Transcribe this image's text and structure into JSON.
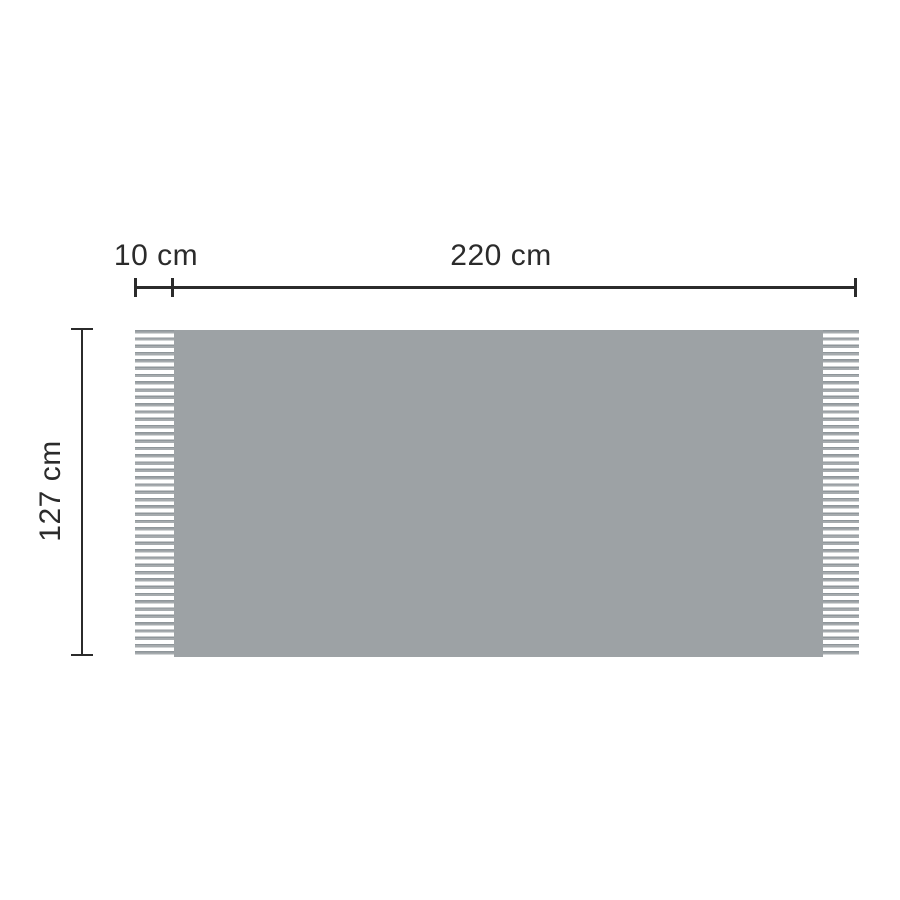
{
  "diagram": {
    "labels": {
      "fringe_width": "10 cm",
      "total_width": "220 cm",
      "height": "127 cm"
    },
    "colors": {
      "blanket_body": "#9DA2A5",
      "fringe_strand": "#9BA1A4",
      "dimension_line": "#2B2B2B",
      "label_text": "#2B2B2B",
      "background": "#FFFFFF"
    }
  }
}
